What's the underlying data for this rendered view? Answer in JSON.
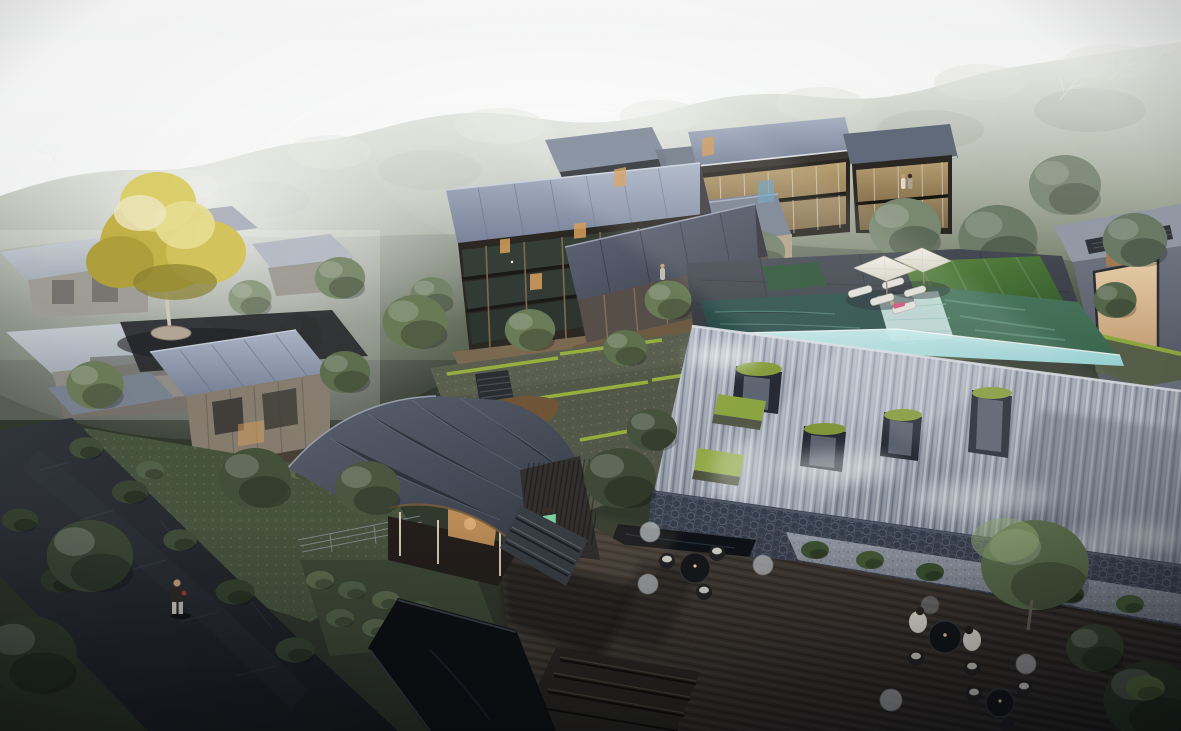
{
  "scene": {
    "type": "architectural-rendering",
    "title": "Hillside resort village — aerial dusk rendering",
    "time_of_day": "dusk with bright haze from upper left",
    "landmarks": {
      "forest": "wooded hillside backdrop",
      "main_lodge": "three-storey timber-and-glass lodge",
      "front_lodge": "two-storey charcoal-roof pavilion",
      "guest_wings": "twin glazed guest wings with warm interiors",
      "infinity_pool": "rooftop infinity pool with sun deck, umbrellas and loungers",
      "waterfall_wall": "sloped cascading waterfall feature wall with mossy niches",
      "basin": "rippled stone cascade basin",
      "tea_pavilion": "curved-roof tea pavilion with lit porch",
      "timber_deck": "outdoor timber dining deck with cafe tables",
      "stone_path": "dark flagstone footpath with walking figure",
      "yellow_tree": "golden feature tree on circular planter",
      "guest_cabins": "grey-roof guest cabins among gardens"
    }
  },
  "palette": {
    "sky_top": "#ffffff",
    "sky_bottom": "#edf1ee",
    "forest_light": "#97a385",
    "forest_dark": "#4e5a44",
    "haze": "#ffffff",
    "roof_steel_light": "#aeb8c9",
    "roof_steel_dark": "#79839a",
    "roof_charcoal": "#3c414e",
    "facade_timber": "#2c2824",
    "timber_warm": "#8a6f4e",
    "window_glow": "#c7ad7c",
    "interior_warm": "#f0d5ae",
    "pool_green": "#3e6b52",
    "pool_aqua": "#9fe0e2",
    "lawn_green": "#5d8a43",
    "moss_green": "#8aa23f",
    "waterfall_light": "#b3bac7",
    "waterfall_dark": "#7e8795",
    "stone_terrace": "#474c55",
    "gravel": "#99a1ac",
    "deck_wood_light": "#4d443b",
    "deck_wood_dark": "#262220",
    "path_stone": "#17191d",
    "tree_gold": "#c9b84a",
    "tree_sage": "#6e7f5c",
    "tree_deep": "#3c4836",
    "umbrella_white": "#f8f6ee",
    "figure_pink": "#d6527e",
    "figure_green_dress": "#7fd4a0"
  }
}
